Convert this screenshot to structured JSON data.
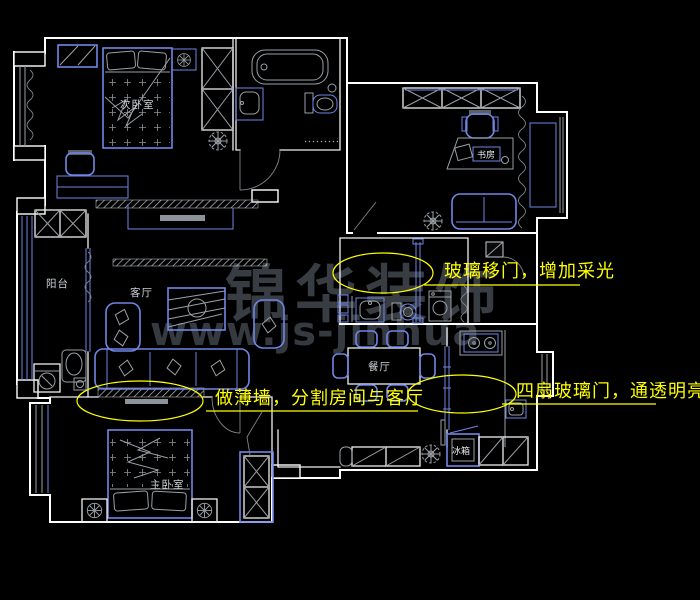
{
  "drawing": {
    "type": "apartment-floor-plan",
    "background": "#000000",
    "palette": {
      "wall": "#ffffff",
      "fixture_blue": "#7086e6",
      "furniture_gray": "#9aa0a6",
      "annotation_yellow": "#ffff00",
      "room_label": "#ccd1d7",
      "watermark": "#3f444c"
    },
    "rooms": {
      "secondary_bedroom": "次卧室",
      "study": "书房",
      "balcony": "阳台",
      "living_room": "客厅",
      "dining_room": "餐厅",
      "master_bedroom": "主卧室"
    },
    "appliances": {
      "fridge": "冰箱"
    },
    "annotations": {
      "glass_sliding_door": "玻璃移门，增加采光",
      "thin_wall": "做薄墙，分割房间与客厅",
      "four_glass_doors": "四扇玻璃门，通透明亮"
    },
    "watermark": {
      "brand": "锦华装饰",
      "website": "www.js-jinhua"
    }
  }
}
